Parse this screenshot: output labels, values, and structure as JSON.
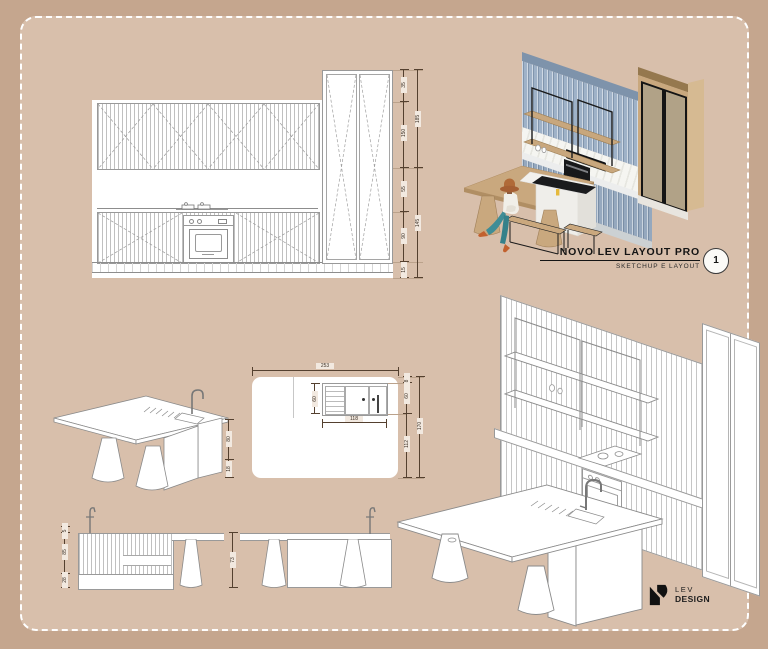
{
  "poster": {
    "bg_outer": "#c5a68e",
    "bg_inner": "#d8bfab",
    "border_color": "#ffffff"
  },
  "title_block": {
    "title": "NOVO LEV LAYOUT PRO",
    "subtitle": "SKETCHUP E LAYOUT",
    "sheet_number": "1"
  },
  "logo": {
    "name": "LEV",
    "suffix": "DESIGN"
  },
  "palette": {
    "cabinet_blue": "#9fb2c8",
    "cabinet_blue_top": "#7e93ab",
    "wood": "#c9a87e",
    "metal_black": "#1b1b1d",
    "counter": "#e9eae7",
    "teal_pants": "#3f8d96",
    "hat_orange": "#b06a38",
    "line_gray": "#999999"
  },
  "dimensions": {
    "elevation_main": {
      "inner": [
        "35",
        "150",
        "55",
        "90",
        "15"
      ],
      "outer": [
        "185",
        "145"
      ]
    },
    "plan_island": {
      "top_width": "253",
      "sink_width": "118",
      "sink_depth": "60",
      "right_inner": [
        "8",
        "60",
        "112"
      ],
      "right_outer": "170"
    },
    "iso_island": {
      "heights": [
        "80",
        "18"
      ]
    },
    "island_front_elevation": {
      "left": [
        "5",
        "85",
        "28"
      ],
      "table_height": "73"
    }
  }
}
